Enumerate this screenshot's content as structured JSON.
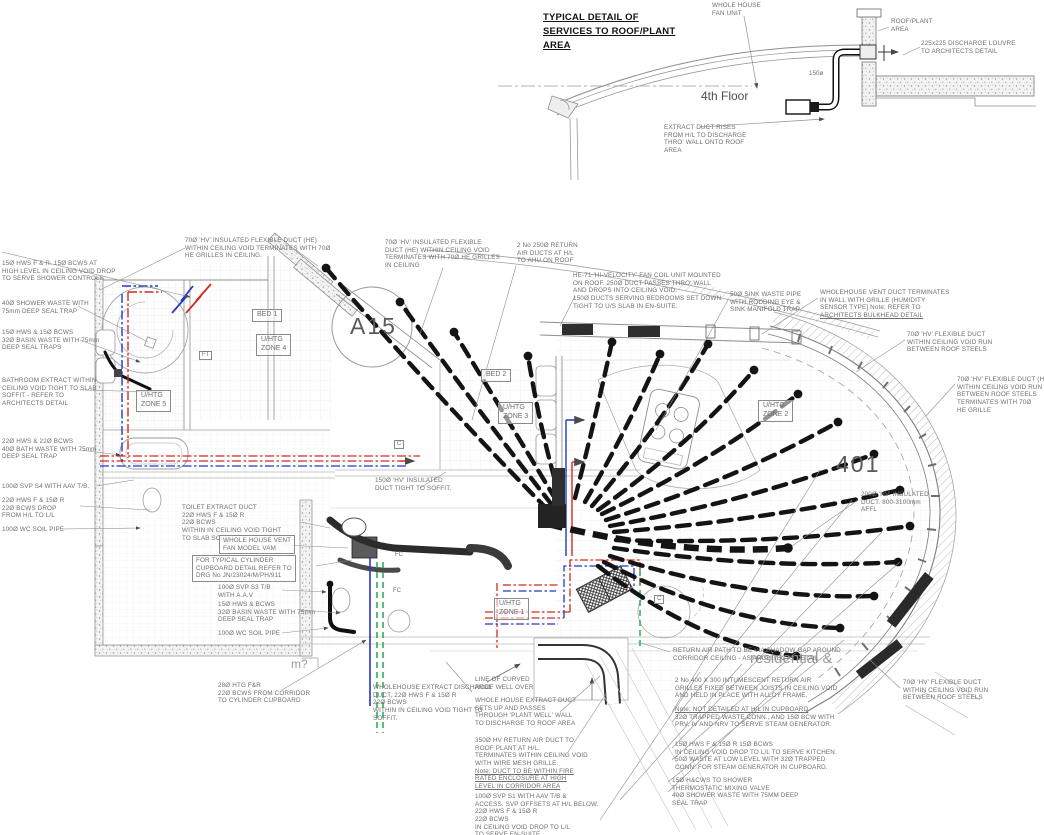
{
  "colors": {
    "hot_pipe": "#d42a1e",
    "cold_pipe": "#2436c8",
    "heating_pipe": "#1fab4a",
    "duct": "#141414",
    "linework": "#8f8f8f",
    "annotation_text": "#6e6e6e"
  },
  "detail": {
    "title": "TYPICAL DETAIL OF\nSERVICES TO ROOF/PLANT\nAREA",
    "annotations": [
      {
        "id": "whole-house-fan-note",
        "x": 712,
        "y": 2,
        "lines": [
          "WHOLE HOUSE",
          "FAN UNIT"
        ]
      },
      {
        "id": "roof-plant-area-note",
        "x": 891,
        "y": 18,
        "lines": [
          "ROOF/PLANT",
          "AREA"
        ]
      },
      {
        "id": "discharge-louvre-note",
        "x": 921,
        "y": 40,
        "lines": [
          "225x225 DISCHARGE LOUVRE",
          "TO ARCHITECTS DETAIL"
        ]
      },
      {
        "id": "extract-duct-rises-note",
        "x": 664,
        "y": 124,
        "lines": [
          "EXTRACT DUCT RISES",
          "FROM H/L TO DISCHARGE",
          "THRO' WALL ONTO ROOF",
          "AREA"
        ]
      }
    ],
    "labels": [
      {
        "id": "floor-label",
        "text": "4th Floor",
        "x": 701,
        "y": 89,
        "cls": "big"
      },
      {
        "id": "duct-size-label",
        "text": "150ø",
        "x": 809,
        "y": 70,
        "cls": "tiny"
      }
    ]
  },
  "plan": {
    "labels": [
      {
        "id": "room-bed1",
        "text": "BED 1",
        "x": 252,
        "y": 309,
        "boxed": true
      },
      {
        "id": "room-bed2",
        "text": "BED 2",
        "x": 481,
        "y": 369,
        "boxed": true
      },
      {
        "id": "zone4-label",
        "text": "U/HTG\nZONE 4",
        "x": 256,
        "y": 334,
        "boxed": true
      },
      {
        "id": "zone5-label",
        "text": "U/HTG\nZONE 5",
        "x": 136,
        "y": 390,
        "boxed": true
      },
      {
        "id": "zone3-label",
        "text": "U/HTG\nZONE 3",
        "x": 498,
        "y": 402,
        "boxed": true
      },
      {
        "id": "zone2-label",
        "text": "U/HTG\nZONE 2",
        "x": 758,
        "y": 400,
        "boxed": true
      },
      {
        "id": "zone1-label",
        "text": "U/HTG\nZONE 1",
        "x": 494,
        "y": 598,
        "boxed": true
      },
      {
        "id": "ft-marker",
        "text": "FT",
        "x": 199,
        "y": 351,
        "boxed": true,
        "cls": "xs"
      },
      {
        "id": "c-marker-1",
        "text": "C",
        "x": 394,
        "y": 440,
        "boxed": true,
        "cls": "xs"
      },
      {
        "id": "c-marker-2",
        "text": "C",
        "x": 654,
        "y": 595,
        "boxed": true,
        "cls": "xs"
      },
      {
        "id": "fc-marker-1",
        "text": "FC",
        "x": 393,
        "y": 552,
        "cls": "xs"
      },
      {
        "id": "fc-marker-2",
        "text": "FC",
        "x": 391,
        "y": 588,
        "cls": "xs"
      },
      {
        "id": "drawing-ref-a15",
        "text": "A15",
        "x": 350,
        "y": 312,
        "cls": "huge"
      },
      {
        "id": "unit-number-401",
        "text": "401",
        "x": 836,
        "y": 450,
        "cls": "huge"
      },
      {
        "id": "watermark-residential",
        "text": "residential &",
        "x": 750,
        "y": 650,
        "cls": "wm"
      },
      {
        "id": "watermark-m",
        "text": "m?",
        "x": 291,
        "y": 657,
        "cls": "wm2"
      }
    ],
    "annotations": [
      {
        "id": "note-shower-controls",
        "x": 2,
        "y": 260,
        "lines": [
          "15Ø HWS F & R.  15Ø BCWS AT",
          "HIGH LEVEL IN CEILING VOID DROP",
          "TO SERVE SHOWER CONTROLS"
        ]
      },
      {
        "id": "note-shower-waste",
        "x": 2,
        "y": 300,
        "lines": [
          "40Ø SHOWER WASTE WITH",
          "75mm DEEP SEAL TRAP"
        ]
      },
      {
        "id": "note-basin-waste-left",
        "x": 2,
        "y": 329,
        "lines": [
          "15Ø HWS & 15Ø BCWS",
          "32Ø BASIN WASTE WITH 75mm",
          "DEEP SEAL TRAPS"
        ]
      },
      {
        "id": "note-bathroom-extract",
        "x": 2,
        "y": 377,
        "lines": [
          "BATHROOM EXTRACT WITHIN",
          "CEILING VOID TIGHT TO SLAB",
          "SOFFIT - REFER TO",
          "ARCHITECTS DETAIL"
        ]
      },
      {
        "id": "note-bath-waste",
        "x": 2,
        "y": 438,
        "lines": [
          "22Ø HWS & 22Ø BCWS",
          "40Ø BATH WASTE WITH 75mm",
          "DEEP SEAL TRAP"
        ]
      },
      {
        "id": "note-svp-s4",
        "x": 2,
        "y": 483,
        "lines": [
          "100Ø SVP S4 WITH AAV T/B."
        ]
      },
      {
        "id": "note-bcws-drop",
        "x": 2,
        "y": 497,
        "lines": [
          "22Ø HWS F & 15Ø R",
          "22Ø BCWS DROP",
          "FROM H/L TO L/L"
        ]
      },
      {
        "id": "note-wc-soil-left",
        "x": 2,
        "y": 526,
        "lines": [
          "100Ø WC SOIL PIPE"
        ]
      },
      {
        "id": "note-flex-duct-bed1",
        "x": 185,
        "y": 237,
        "lines": [
          "70Ø 'HV' INSULATED FLEXIBLE DUCT (HE)",
          "WITHIN CEILING VOID TERMINATES WITH 70Ø",
          "HE GRILLES IN CEILING."
        ]
      },
      {
        "id": "note-flex-duct-bed2",
        "x": 385,
        "y": 239,
        "lines": [
          "70Ø 'HV' INSULATED FLEXIBLE",
          "DUCT (HE) WITHIN CEILING VOID",
          "TERMINATES WITH 70Ø HE GRILLES",
          "IN CEILING"
        ]
      },
      {
        "id": "note-return-air-ducts",
        "x": 517,
        "y": 242,
        "lines": [
          "2 No 250Ø RETURN",
          "AIR DUCTS AT H/L",
          "TO AHU ON ROOF"
        ]
      },
      {
        "id": "note-fan-coil-unit",
        "x": 573,
        "y": 272,
        "lines": [
          "HE-71 'HI-VELOCITY' FAN COIL UNIT MOUNTED",
          "ON ROOF. 250Ø DUCT PASSES THRO' WALL",
          "AND DROPS INTO CEILING VOID.",
          "150Ø DUCTS SERVING BEDROOMS SET DOWN",
          "TIGHT TO U/S SLAB IN EN-SUITE."
        ]
      },
      {
        "id": "note-sink-waste",
        "x": 730,
        "y": 291,
        "lines": [
          "50Ø SINK WASTE PIPE",
          "WITH RODDING EYE &",
          "SINK MANIFOLD TRAP"
        ]
      },
      {
        "id": "note-wholehouse-vent",
        "x": 820,
        "y": 289,
        "u": [
          3
        ],
        "lines": [
          "WHOLEHOUSE VENT DUCT TERMINATES",
          "IN WALL WITH GRILLE (HUMIDITY",
          "SENSOR TYPE]  Note; REFER TO",
          "ARCHITECTS BULKHEAD DETAIL"
        ]
      },
      {
        "id": "note-flex-duct-right-upper",
        "x": 907,
        "y": 331,
        "lines": [
          "70Ø 'HV' FLEXIBLE DUCT",
          "WITHIN CEILING VOID  RUN",
          "BETWEEN ROOF STEELS"
        ]
      },
      {
        "id": "note-flex-duct-right-mid",
        "x": 957,
        "y": 376,
        "lines": [
          "70Ø 'HV' FLEXIBLE DUCT (HE)",
          "WITHIN CEILING VOID RUN",
          "BETWEEN ROOF STEELS",
          "TERMINATES WITH 70Ø",
          "HE GRILLE"
        ]
      },
      {
        "id": "note-150-duct-soffit",
        "x": 375,
        "y": 477,
        "lines": [
          "150Ø 'HV' INSULATED",
          "DUCT TIGHT TO SOFFIT."
        ]
      },
      {
        "id": "note-200-duct",
        "x": 861,
        "y": 491,
        "lines": [
          "200Ø 'HV' INSULATED",
          "DUCT. 800-3100mm",
          "AFFL"
        ]
      },
      {
        "id": "note-toilet-extract",
        "x": 182,
        "y": 504,
        "lines": [
          "TOILET EXTRACT DUCT",
          "22Ø HWS F & 15Ø R",
          "22Ø BCWS",
          "WITHIN IN CEILING VOID TIGHT",
          "TO SLAB SOFFIT"
        ]
      },
      {
        "id": "note-vent-fan-model",
        "x": 219,
        "y": 535,
        "boxed": true,
        "lines": [
          "WHOLE HOUSE VENT",
          "FAN MODEL VAM"
        ]
      },
      {
        "id": "note-cylinder-cupboard",
        "x": 192,
        "y": 555,
        "boxed": true,
        "lines": [
          "FOR TYPICAL CYLINDER",
          "CUPBOARD DETAIL REFER TO",
          "DRG No JN/23024/M/PH/911"
        ]
      },
      {
        "id": "note-svp-s3",
        "x": 218,
        "y": 584,
        "lines": [
          "100Ø SVP S3 T/B",
          "WITH A.A.V"
        ]
      },
      {
        "id": "note-basin-waste-mid",
        "x": 218,
        "y": 601,
        "lines": [
          "15Ø HWS & BCWS",
          "32Ø BASIN WASTE WITH 75mm",
          "DEEP SEAL TRAP"
        ]
      },
      {
        "id": "note-wc-soil-mid",
        "x": 218,
        "y": 630,
        "lines": [
          "100Ø WC SOIL PIPE"
        ]
      },
      {
        "id": "note-htg-from-corridor",
        "x": 218,
        "y": 682,
        "lines": [
          "28Ø HTG F&R",
          "22Ø BCWS FROM CORRIDOR",
          "TO CYLINDER CUPBOARD"
        ]
      },
      {
        "id": "note-extract-discharge",
        "x": 373,
        "y": 684,
        "lines": [
          "WHOLEHOUSE EXTRACT DISCHARGE",
          "DUCT,  22Ø HWS F & 15Ø R",
          "22Ø BCWS",
          "WITHIN IN CEILING VOID TIGHT TO",
          "SOFFIT."
        ]
      },
      {
        "id": "note-roof-well",
        "x": 475,
        "y": 676,
        "lines": [
          "LINE OF CURVED",
          "ROOF WELL OVER"
        ]
      },
      {
        "id": "note-plant-well",
        "x": 475,
        "y": 697,
        "lines": [
          "WHOLE HOUSE EXTRACT DUCT",
          "SETS UP AND PASSES",
          "THROUGH 'PLANT WELL' WALL",
          "TO DISCHARGE TO ROOF AREA"
        ]
      },
      {
        "id": "note-350-return-air",
        "x": 475,
        "y": 737,
        "u": [
          4,
          5,
          6
        ],
        "lines": [
          "350Ø HV RETURN AIR DUCT TO",
          "ROOF PLANT AT H/L.",
          "TERMINATES WITHIN CEILING VOID",
          "WITH WIRE MESH GRILLE.",
          "Note: DUCT TO BE WITHIN FIRE",
          "RATED ENCLOSURE AT HIGH",
          "LEVEL IN CORRIDOR AREA"
        ]
      },
      {
        "id": "note-svp-s1",
        "x": 475,
        "y": 793,
        "lines": [
          "100Ø SVP S1 WITH AAV T/B &",
          "ACCESS. SVP OFFSETS AT H/L BELOW.",
          "22Ø HWS F & 15Ø R",
          "22Ø BCWS",
          "IN CEILING VOID DROP TO L/L",
          "TO SERVE EN-SUITE."
        ]
      },
      {
        "id": "note-shadow-gap",
        "x": 673,
        "y": 647,
        "lines": [
          "RETURN AIR PATH TO BE VIA SHADOW GAP AROUND",
          "CORRIDOR CEILING - AS ARCHITECTS DETAIL"
        ]
      },
      {
        "id": "note-intumescent-grilles",
        "x": 675,
        "y": 677,
        "lines": [
          "2 No 400 X 300 INTUMESCENT RETURN AIR",
          "GRILLES FIXED BETWEEN JOISTS IN CEILING VOID",
          "AND HELD IN PLACE WITH ALLOY FRAME."
        ]
      },
      {
        "id": "note-steam-generator",
        "x": 675,
        "y": 706,
        "u": [
          0
        ],
        "lines": [
          "Note: NOT DETAILED AT H/L IN CUPBOARD",
          "32Ø TRAPPED WASTE CONN., AND 15Ø BCW WITH",
          "PRV, IV AND NRV TO SERVE STEAM GENERATOR."
        ]
      },
      {
        "id": "note-kitchen-drop",
        "x": 675,
        "y": 741,
        "lines": [
          "15Ø HWS F & 15Ø R    15Ø BCWS",
          "IN CEILING VOID DROP TO L/L TO SERVE KITCHEN.",
          "50Ø WASTE AT LOW LEVEL WITH 32Ø TRAPPED",
          "CONN. FOR STEAM GENERATOR IN CUPBOARD."
        ]
      },
      {
        "id": "note-mixing-valve",
        "x": 672,
        "y": 777,
        "lines": [
          "15Ø H&CWS TO SHOWER",
          "THERMOSTATIC MIXING VALVE",
          "40Ø SHOWER WASTE WITH 75MM DEEP",
          "SEAL TRAP"
        ]
      },
      {
        "id": "note-flex-duct-right-lower",
        "x": 903,
        "y": 679,
        "lines": [
          "70Ø 'HV' FLEXIBLE DUCT",
          "WITHIN CEILING VOID  RUN",
          "BETWEEN ROOF STEELS"
        ]
      }
    ]
  }
}
